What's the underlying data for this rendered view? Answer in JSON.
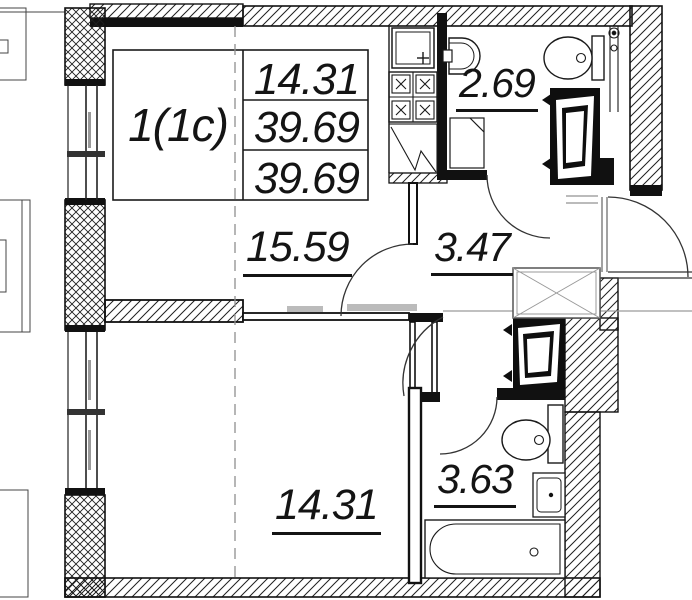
{
  "plan_title": {
    "unit_label": "1(1c)"
  },
  "area_table": {
    "living_area": "14.31",
    "total_area": "39.69",
    "total_area_declared": "39.69"
  },
  "rooms": {
    "living_kitchen": {
      "area": "15.59"
    },
    "wc": {
      "area": "2.69"
    },
    "hall": {
      "area": "3.47"
    },
    "bathroom": {
      "area": "3.63"
    },
    "bedroom": {
      "area": "14.31"
    }
  },
  "colors": {
    "line": "#1a1a1a",
    "zone_line": "#999999"
  }
}
